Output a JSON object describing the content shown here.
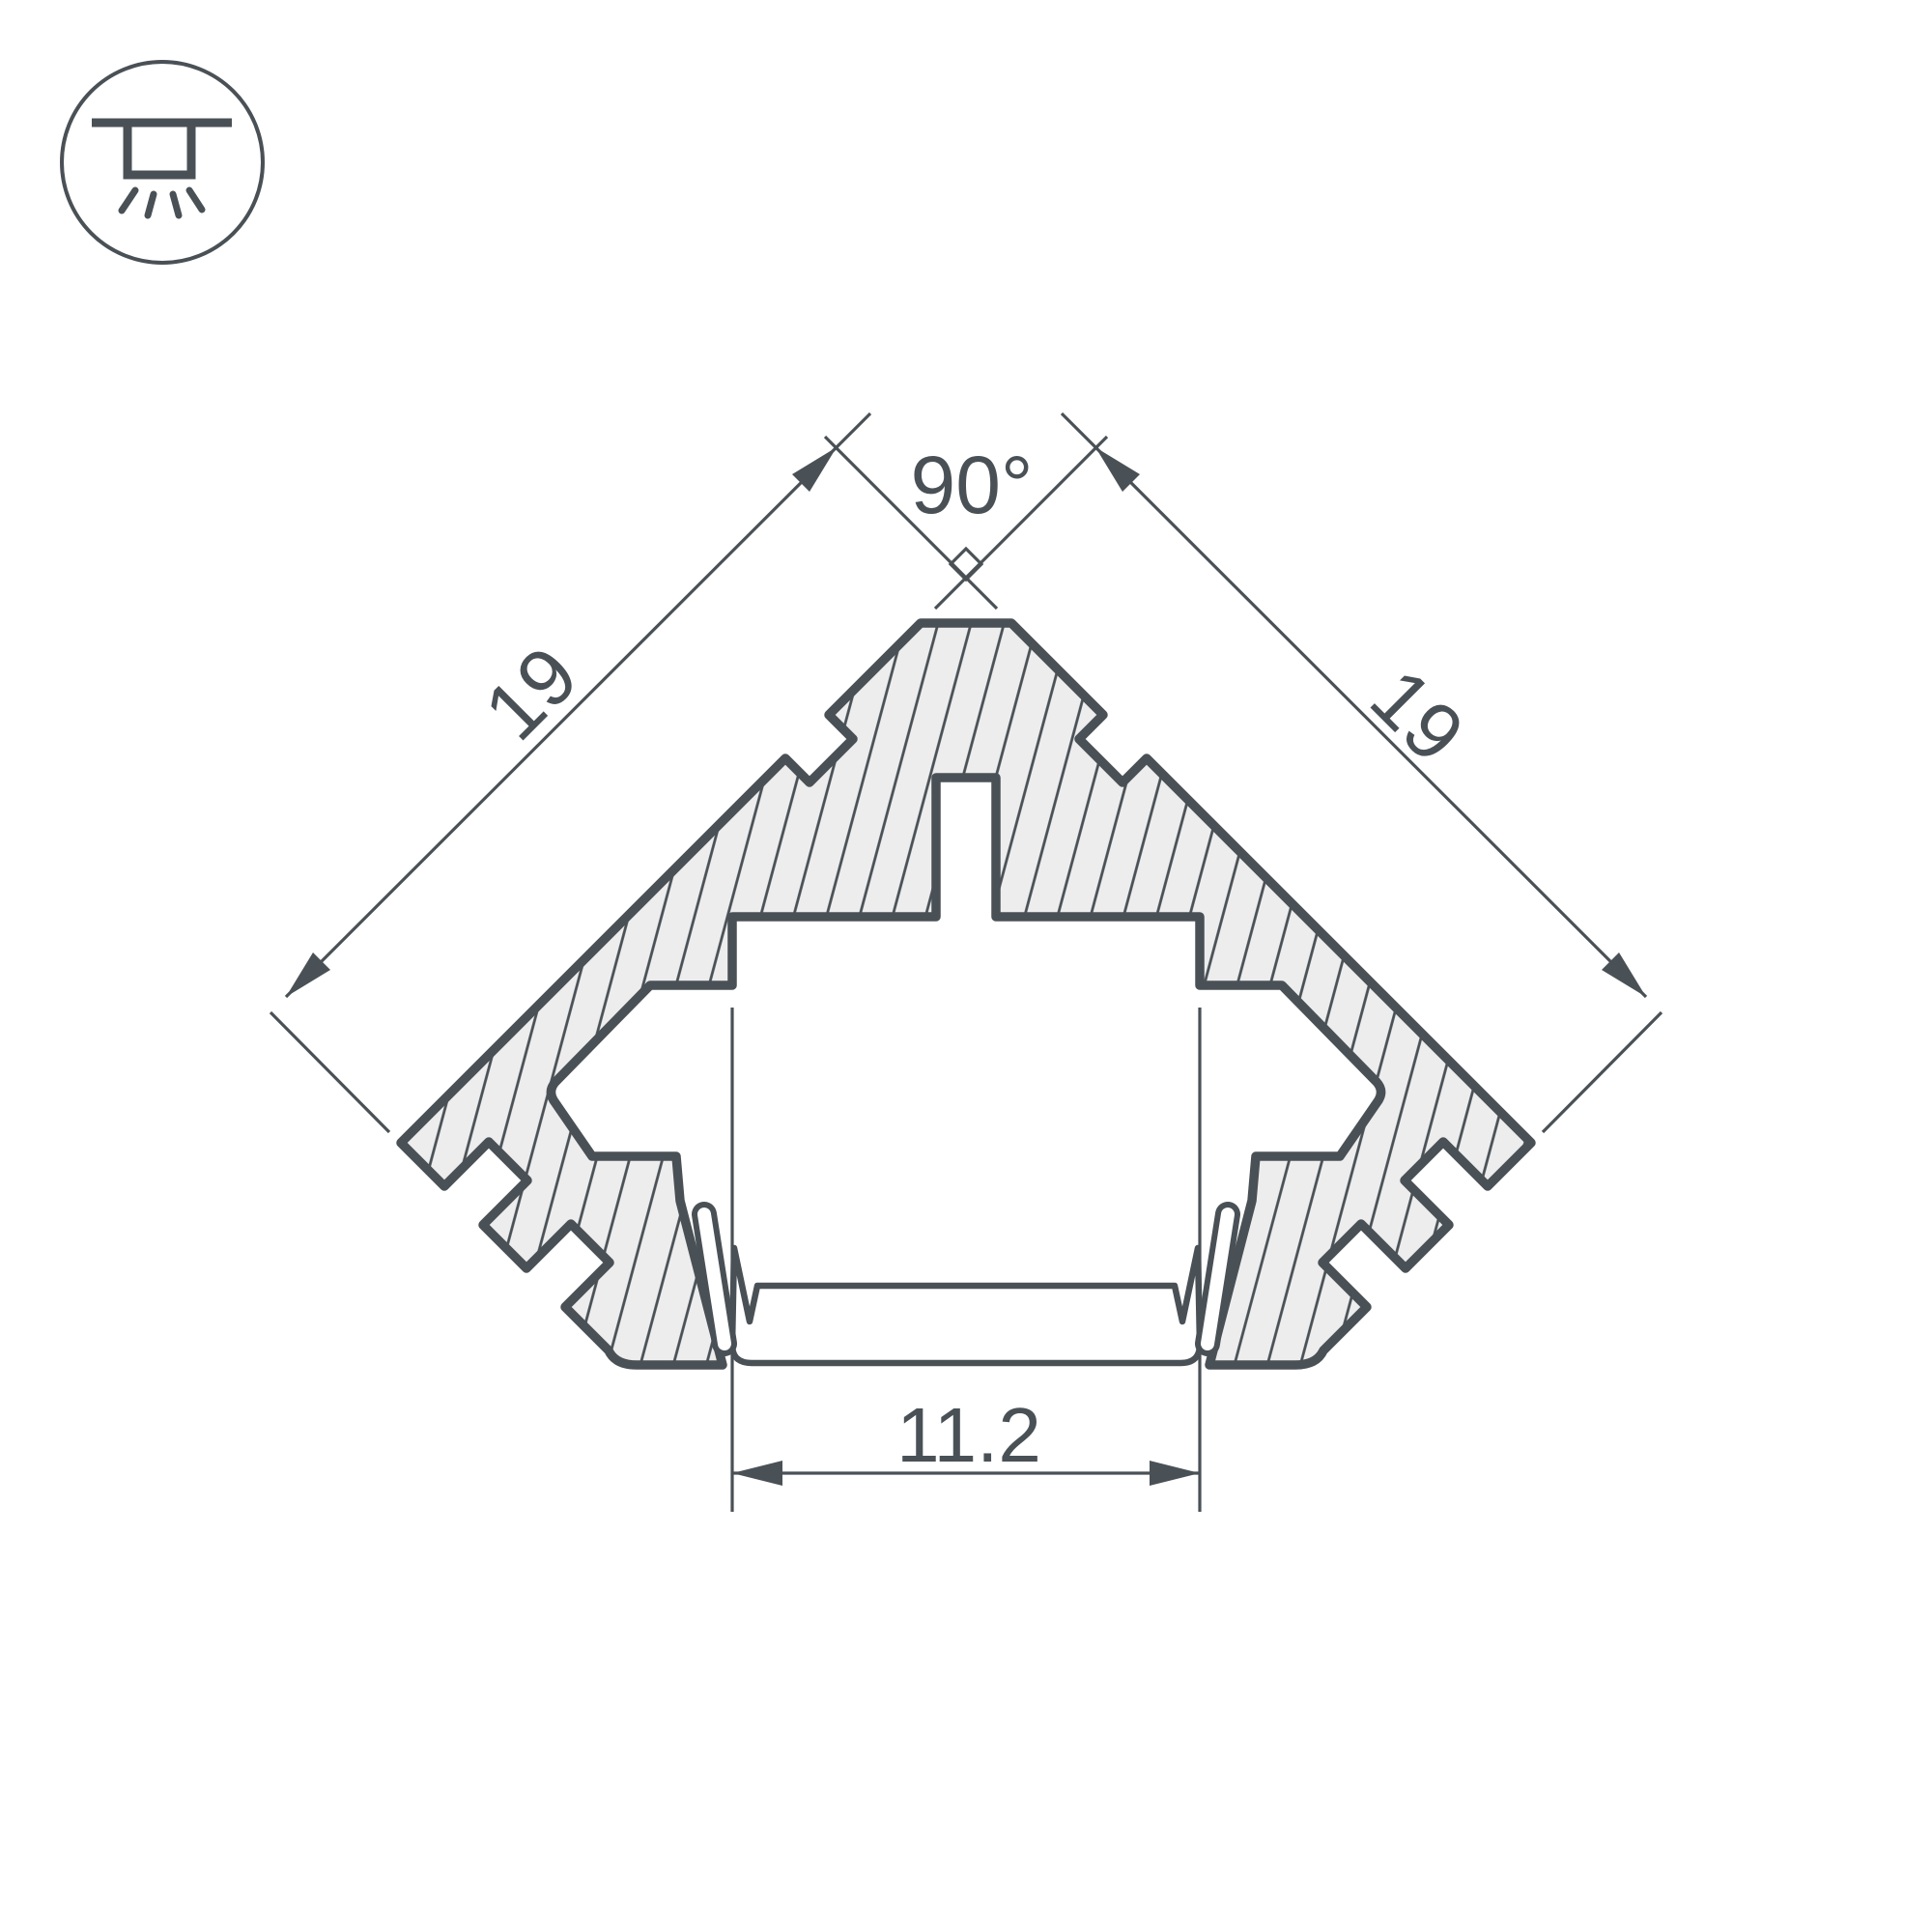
{
  "drawing": {
    "type": "led-profile-cross-section",
    "labels": {
      "angle_top": "90°",
      "side_left": "19",
      "side_right": "19",
      "width_bottom": "11.2"
    }
  },
  "icon": {
    "name": "recessed-ceiling-light"
  },
  "colors": {
    "line": "#4a5156",
    "fill": "#ededee",
    "background": "#ffffff"
  }
}
